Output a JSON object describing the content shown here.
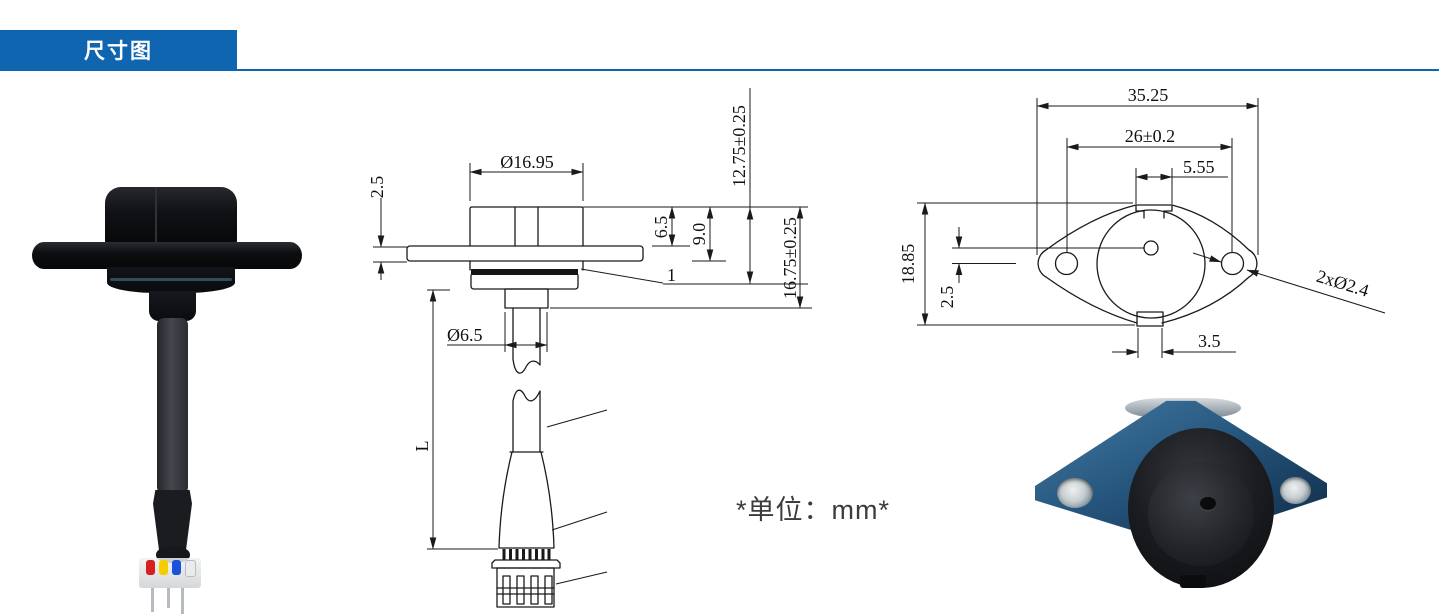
{
  "header": {
    "title": "尺寸图"
  },
  "units_note": "*单位：mm*",
  "colors": {
    "accent_blue": "#0f65af",
    "drawing_line": "#1a1a1a",
    "photo_flange_blue": "#285a82"
  },
  "side_view": {
    "dims": {
      "cap_diameter": "Ø16.95",
      "flange_thickness": "2.5",
      "cap_height": "6.5",
      "head_height": "9.0",
      "height_to_locknut": "12.75±0.25",
      "height_overall": "16.75±0.25",
      "stem_diameter": "Ø6.5",
      "cable_length": "L",
      "gasket_callout": "1"
    }
  },
  "top_view": {
    "dims": {
      "overall_width": "35.25",
      "hole_spacing": "26±0.2",
      "top_notch_width": "5.55",
      "flange_height": "18.85",
      "center_hole_offset": "2.5",
      "bottom_notch_width": "3.5",
      "mounting_holes": "2xØ2.4"
    }
  }
}
